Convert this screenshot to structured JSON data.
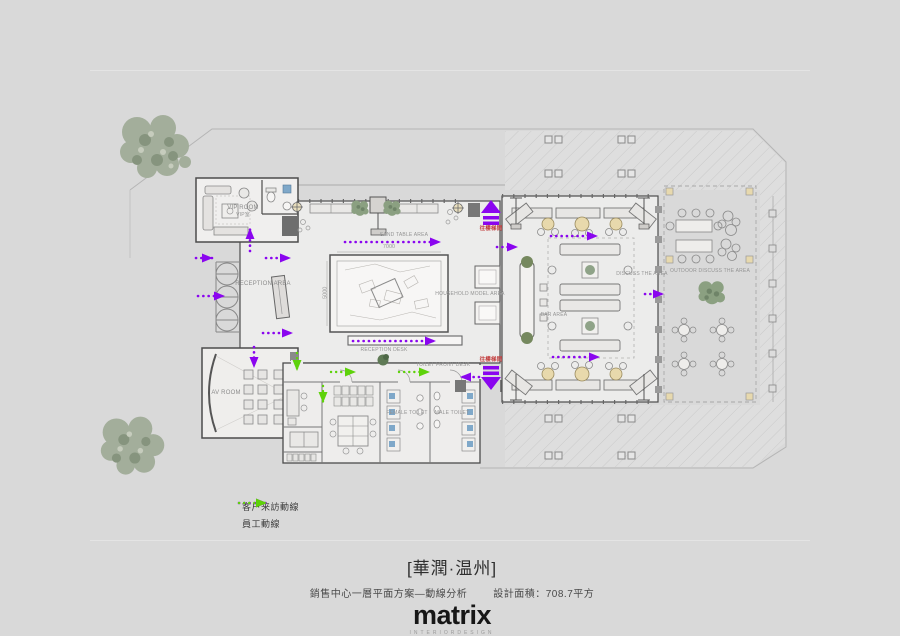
{
  "page": {
    "background": "#d9d9d9"
  },
  "legend": {
    "items": [
      {
        "id": "customer-route",
        "label": "客户来訪動線",
        "color": "#8a05ef"
      },
      {
        "id": "staff-route",
        "label": "員工動線",
        "color": "#5ed20a"
      }
    ]
  },
  "titleblock": {
    "project": "[華潤·温州]",
    "drawing": "銷售中心一層平面方案—動線分析",
    "area": "設計面積：708.7平方",
    "logo": "matrix",
    "logo_sub": "INTERIORDESIGN"
  },
  "plan": {
    "labels": {
      "vip_room": "VIP ROOM",
      "vip_room_zh": "VIP室",
      "reception_area": "RECEPTION AREA",
      "av_room": "AV ROOM",
      "reception_desk": "RECEPTION DESK",
      "sand_table": "SAND TABLE AREA",
      "household_model": "HOUSEHOLD MODEL AREA",
      "bar_area": "BAR AREA",
      "discuss_area": "DISCUSS THE AREA",
      "outdoor_discuss": "OUTDOOR DISCUSS THE AREA",
      "toilet_front_desk": "TOILET FRONT DESK",
      "female_toilet": "FEMALE TOILET",
      "male_toilet": "MALE TOILET",
      "to_stair_up": "往樓梯間",
      "to_stair_down": "往樓梯間"
    },
    "dimensions": {
      "sand_table_width": "7000",
      "sand_table_depth": "5000"
    },
    "colors": {
      "customer_route": "#8a05ef",
      "staff_route": "#5ed20a",
      "stair_note": "#c23b3b",
      "walls": "#4c4c4c"
    }
  }
}
